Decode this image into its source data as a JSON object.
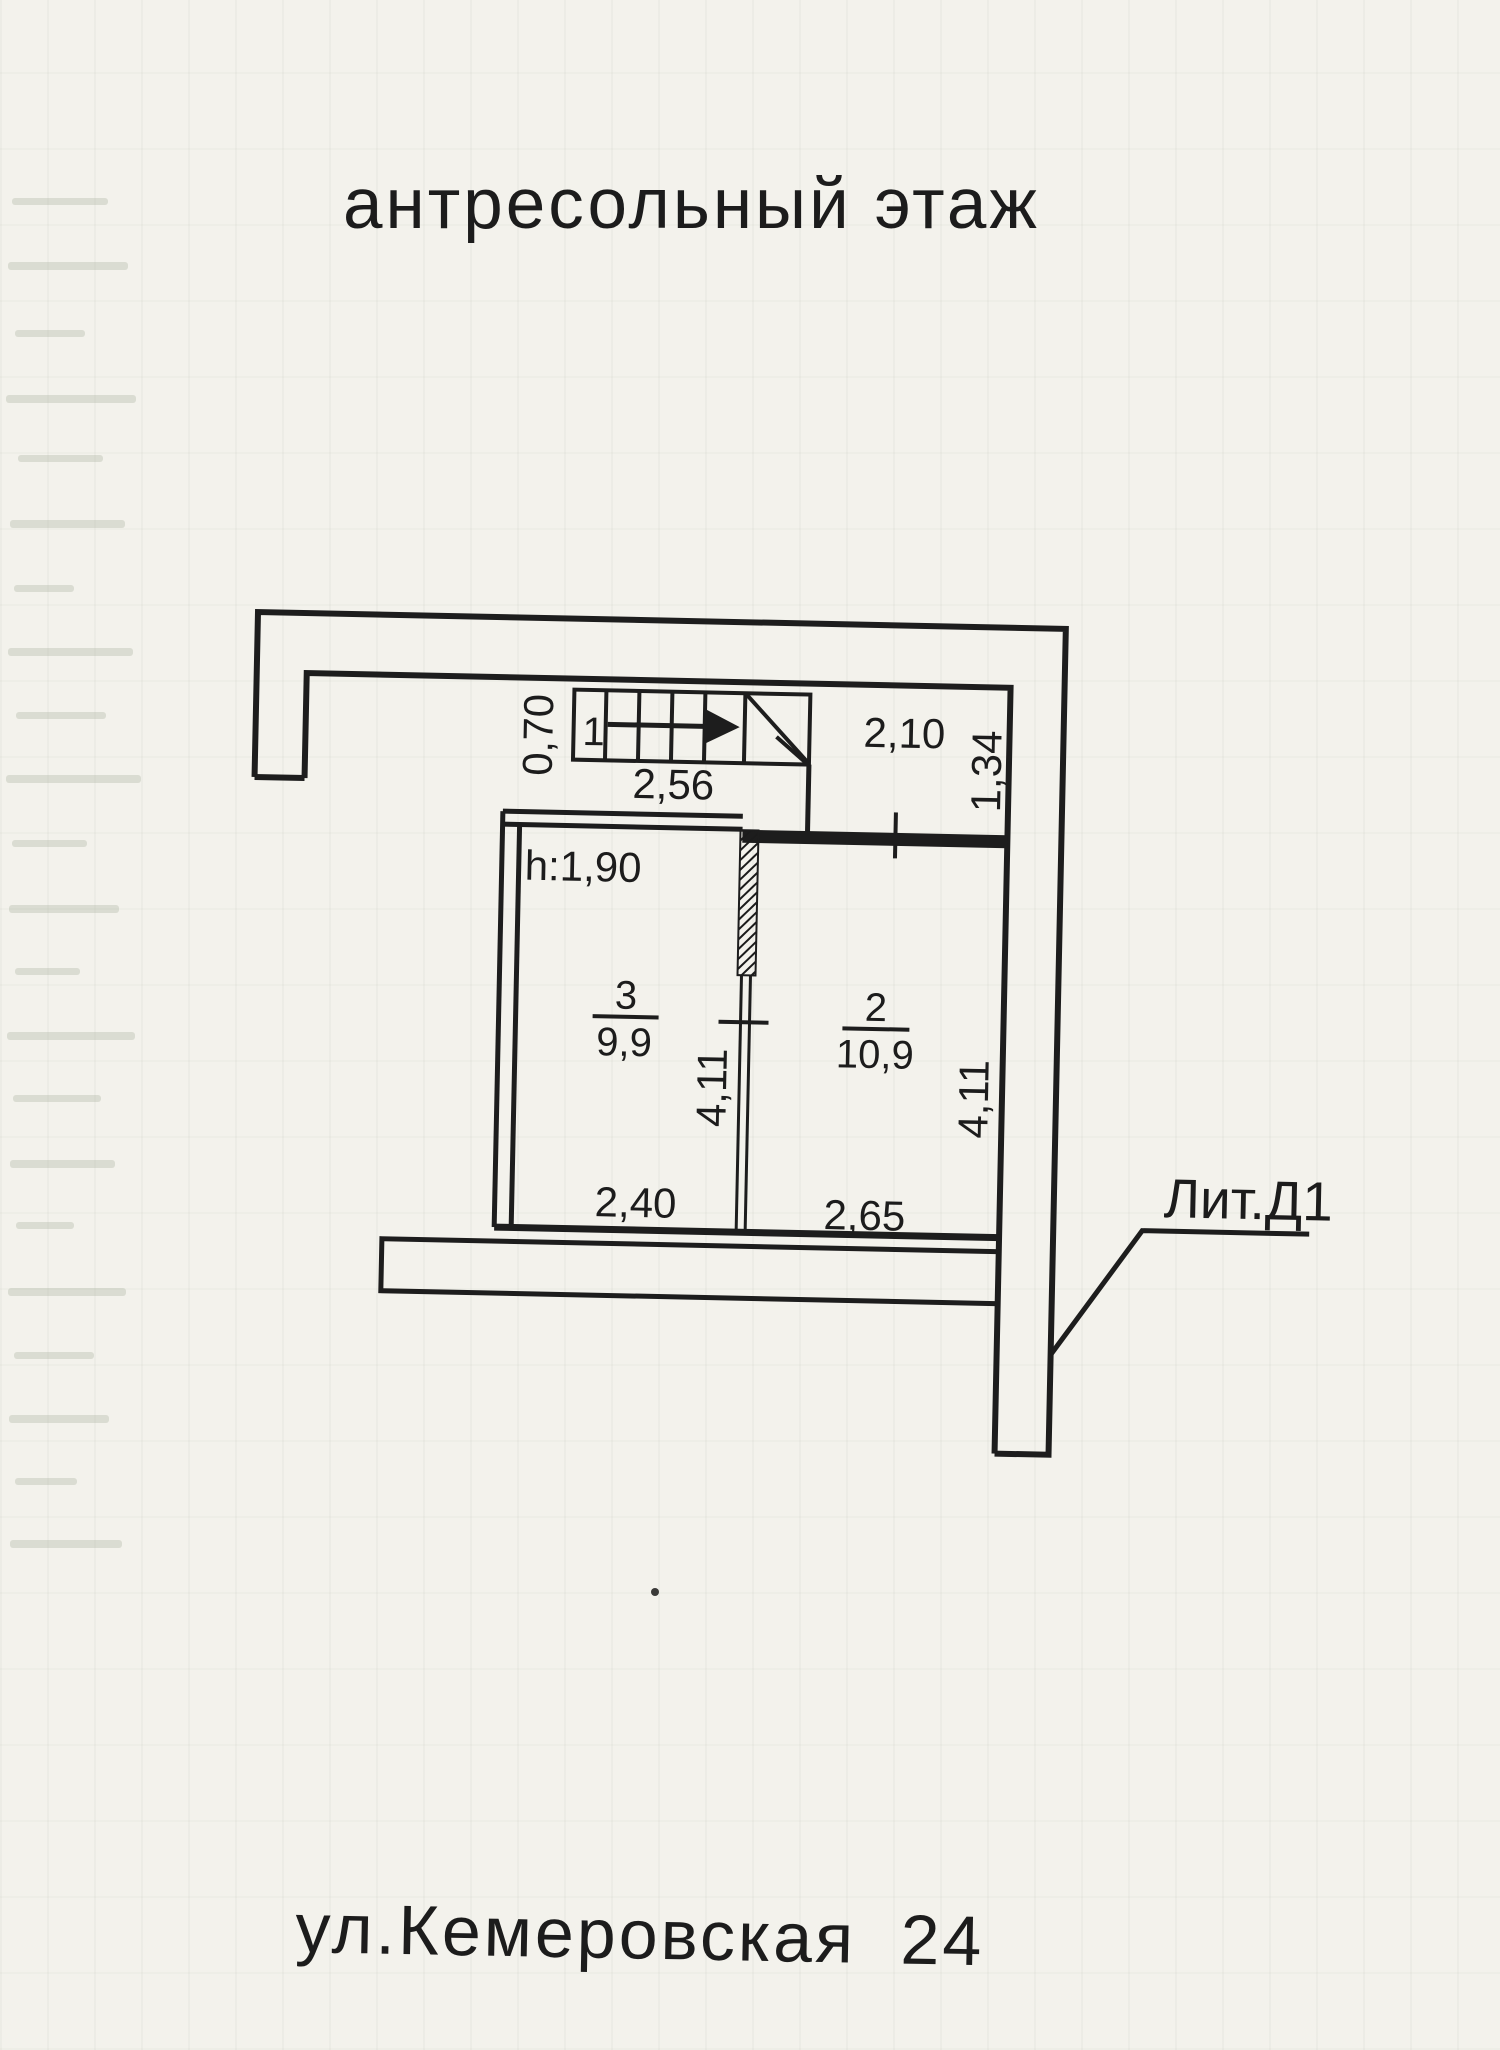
{
  "document": {
    "title": "антресольный этаж",
    "address": "ул.Кемеровская 24",
    "building_label": "Лит.Д1"
  },
  "plan": {
    "height_note": "h:1,90",
    "stair": {
      "number": "1",
      "width": "0,70",
      "length": "2,56"
    },
    "landing": {
      "width": "2,10",
      "depth": "1,34"
    },
    "room3": {
      "number": "3",
      "area": "9,9",
      "width": "2,40",
      "depth": "4,11"
    },
    "room2": {
      "number": "2",
      "area": "10,9",
      "width": "2,65",
      "depth": "4,11"
    }
  }
}
